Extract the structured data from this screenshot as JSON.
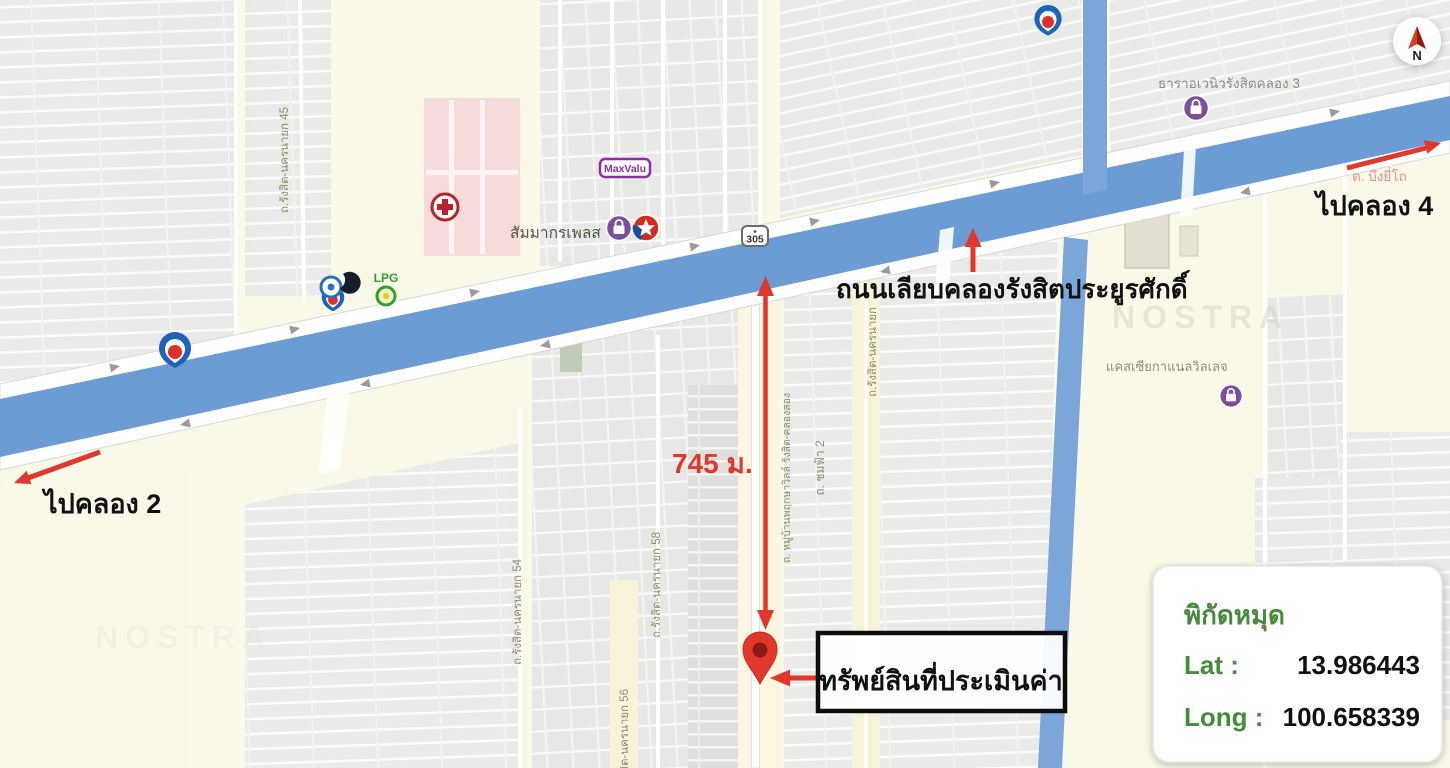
{
  "map_type": "annotated location map (NOSTRA) for property appraisal, Rangsit Khlong 3 area, Pathum Thani, Thailand",
  "watermark": "NOSTRA",
  "colors": {
    "canal_blue": "#6C9CD4",
    "cream_land": "#FAF8E6",
    "gray_block": "#E9E9E9",
    "annotation_red": "#E2382C",
    "coord_green": "#468A3C",
    "road_label_olive": "#8F8F6B",
    "place_label_gray": "#8D8D7F",
    "district_label_pink": "#E19090",
    "hospital_pink": "#F5DCDA"
  },
  "annotations": {
    "to_khlong_2": "ไปคลอง 2",
    "to_khlong_4": "ไปคลอง 4",
    "canal_road_name": "ถนนเลียบคลองรังสิตประยูรศักดิ์",
    "distance": "745 ม.",
    "property_label": "ทรัพย์สินที่ประเมินค่า"
  },
  "coords_panel": {
    "title": "พิกัดหมุด",
    "lat_label": "Lat :",
    "lat_value": "13.986443",
    "long_label": "Long :",
    "long_value": "100.658339"
  },
  "places": {
    "thara_avenue": "ธาราอเวนิวรังสิตคลอง 3",
    "district": "ต. บึงยี่โถ",
    "cassia_village": "แคสเซียกาแนลวิลเลจ",
    "sammakorn_place": "สัมมากรเพลส",
    "maxvalu": "MaxValu",
    "lpg": "LPG",
    "route_shield": "305",
    "compass_n": "N"
  },
  "road_labels": {
    "rangsit_nakhonnayok_45": "ถ.รังสิต-นครนายก 45",
    "rangsit_nakhonnayok_54": "ถ.รังสิต-นครนายก 54",
    "rangsit_nakhonnayok_56": "ถ.รังสิต-นครนายก 56",
    "rangsit_nakhonnayok_58": "ถ.รังสิต-นครนายก 58",
    "rangsit_nakhonnayok": "ถ.รังสิต-นครนายก",
    "chomfa_2": "ถ. ชมฟ้า 2",
    "pruksa_ville": "ถ. หมู่บ้านพฤกษาวิลล์ รังสิต-คลองสอง"
  }
}
